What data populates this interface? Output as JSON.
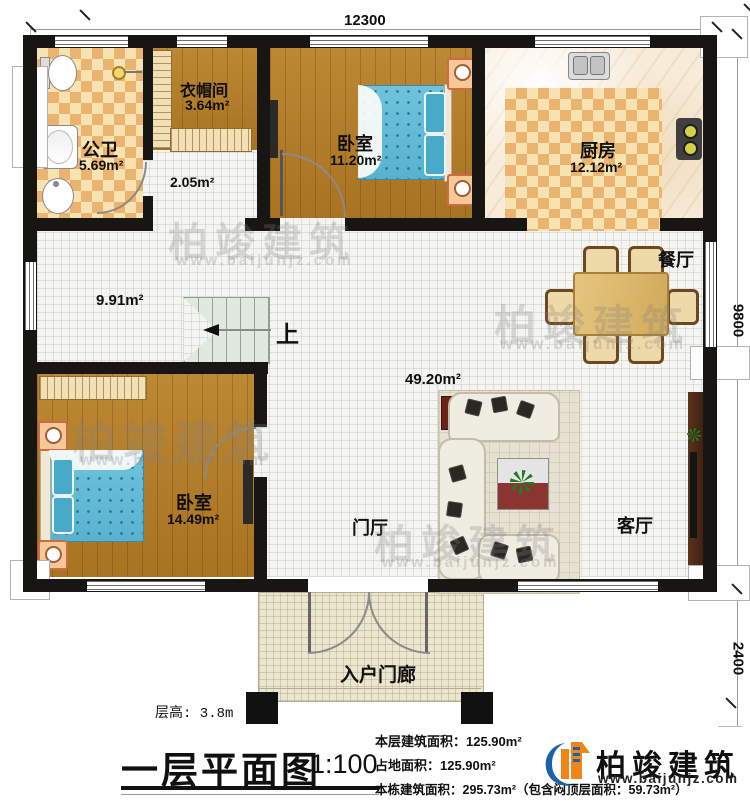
{
  "dimensions": {
    "top": "12300",
    "right": "9800",
    "porch": "2400"
  },
  "rooms": {
    "bathroom": {
      "name": "公卫",
      "area": "5.69m²"
    },
    "cloakroom": {
      "name": "衣帽间",
      "area": "3.64m²"
    },
    "hallway": {
      "area": "2.05m²"
    },
    "bedroom1": {
      "name": "卧室",
      "area": "11.20m²"
    },
    "kitchen": {
      "name": "厨房",
      "area": "12.12m²"
    },
    "dining": {
      "name": "餐厅"
    },
    "stairhall": {
      "area": "9.91m²",
      "up": "上"
    },
    "living_open": {
      "area": "49.20m²"
    },
    "bedroom2": {
      "name": "卧室",
      "area": "14.49m²"
    },
    "foyer": {
      "name": "门厅"
    },
    "living": {
      "name": "客厅"
    },
    "porch": {
      "name": "入户门廊"
    }
  },
  "footer": {
    "floor_height": "层高: 3.8m",
    "title": "一层平面图",
    "scale": "1:100",
    "stat1": "本层建筑面积：125.90m²",
    "stat2": "占地面积：125.90m²",
    "stat3": "本栋建筑面积：295.73m²（包含闷顶层面积：59.73m²）"
  },
  "brand": {
    "name": "柏竣建筑",
    "site": "www.baijunjz.com"
  },
  "watermark": {
    "name": "柏竣建筑",
    "site": "www.baijunjz.com"
  }
}
